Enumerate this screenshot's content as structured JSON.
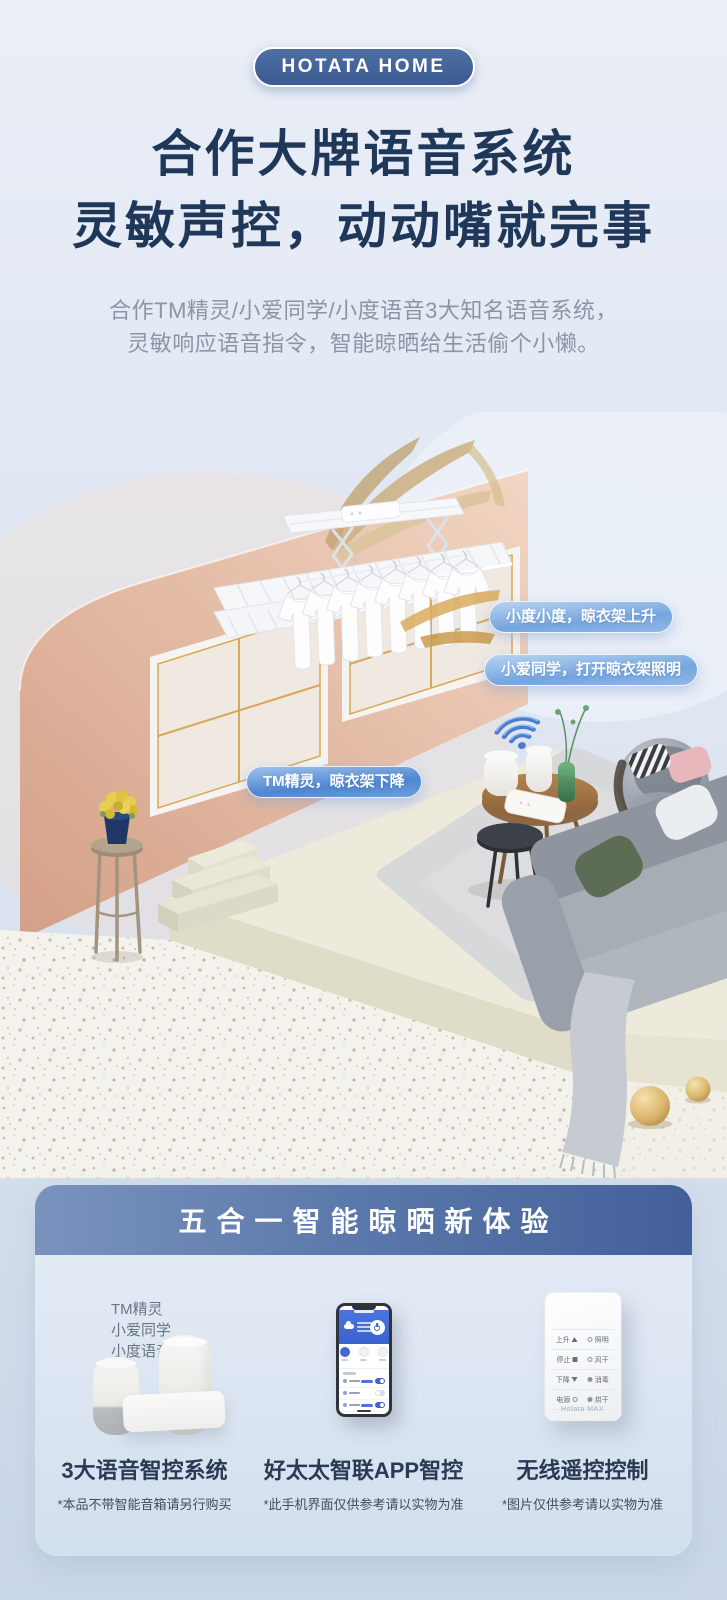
{
  "brand_badge": "HOTATA HOME",
  "hero": {
    "title_line1": "合作大牌语音系统",
    "title_line2": "灵敏声控，动动嘴就完事",
    "subtitle_line1": "合作TM精灵/小爱同学/小度语音3大知名语音系统，",
    "subtitle_line2": "灵敏响应语音指令，智能晾晒给生活偷个小懒。"
  },
  "scene": {
    "voice_bubbles": [
      "小度小度，晾衣架上升",
      "小爱同学，打开晾衣架照明",
      "TM精灵，晾衣架下降"
    ],
    "icons": {
      "wifi": "wifi-icon"
    }
  },
  "panel": {
    "title": "五合一智能晾晒新体验",
    "columns": [
      {
        "speaker_labels": [
          "TM精灵",
          "小爱同学",
          "小度语音"
        ],
        "caption": "3大语音智控系统",
        "footnote": "*本品不带智能音箱请另行购买"
      },
      {
        "caption": "好太太智联APP智控",
        "footnote": "*此手机界面仅供参考请以实物为准"
      },
      {
        "caption": "无线遥控控制",
        "footnote": "*图片仅供参考请以实物为准",
        "remote": {
          "rows": [
            [
              "上升",
              "照明"
            ],
            [
              "停止",
              "风干"
            ],
            [
              "下降",
              "消毒"
            ],
            [
              "电源",
              "烘干"
            ]
          ],
          "brand": "Hotata MAX"
        }
      }
    ]
  },
  "colors": {
    "accent_blue": "#3f68d2",
    "badge_blue": "#45639b",
    "heading_navy": "#1f3859",
    "wall_peach": "#e4b49c"
  }
}
